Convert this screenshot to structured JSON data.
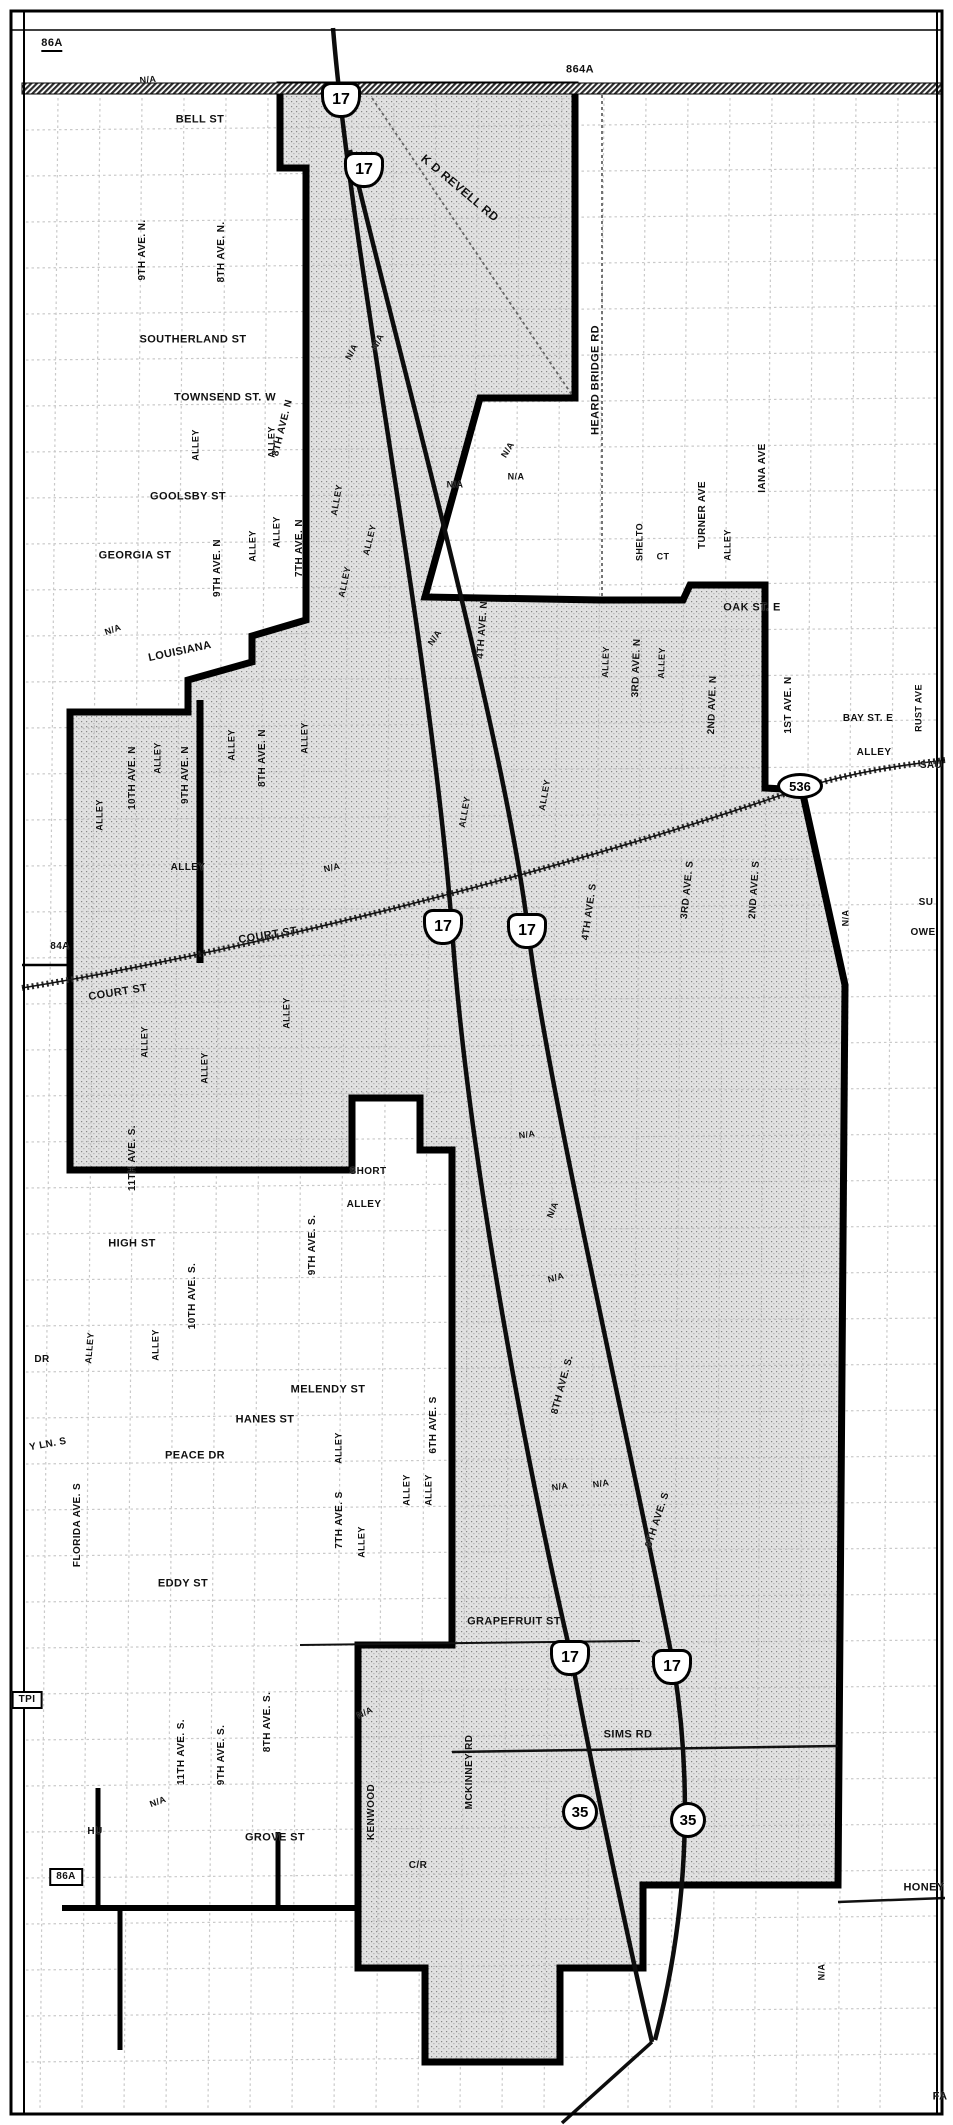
{
  "map": {
    "width": 953,
    "height": 2125,
    "description_labels": {
      "not_applicable": "N/A"
    },
    "colors": {
      "boundary": "#000000",
      "shade_base": "#e1e1e1",
      "shade_dot": "#808080",
      "road": "#111111",
      "grid_line": "#b8b8b8",
      "paper": "#ffffff"
    }
  },
  "route_shields": [
    {
      "kind": "us",
      "num": "17",
      "x": 341,
      "y": 100
    },
    {
      "kind": "us",
      "num": "17",
      "x": 364,
      "y": 170
    },
    {
      "kind": "us",
      "num": "17",
      "x": 443,
      "y": 927
    },
    {
      "kind": "us",
      "num": "17",
      "x": 527,
      "y": 931
    },
    {
      "kind": "us",
      "num": "17",
      "x": 570,
      "y": 1658
    },
    {
      "kind": "us",
      "num": "17",
      "x": 672,
      "y": 1667
    },
    {
      "kind": "circle",
      "num": "35",
      "x": 580,
      "y": 1812
    },
    {
      "kind": "circle",
      "num": "35",
      "x": 688,
      "y": 1820
    },
    {
      "kind": "oval",
      "num": "536",
      "x": 800,
      "y": 786
    }
  ],
  "labels": [
    {
      "t": "86A",
      "x": 52,
      "y": 45,
      "s": 11,
      "u": 1
    },
    {
      "t": "864A",
      "x": 580,
      "y": 70,
      "s": 11
    },
    {
      "t": "N/A",
      "x": 148,
      "y": 80,
      "s": 9,
      "r": -5
    },
    {
      "t": "BELL ST",
      "x": 200,
      "y": 120,
      "s": 11
    },
    {
      "t": "K D REVELL RD",
      "x": 460,
      "y": 188,
      "s": 12,
      "r": 40
    },
    {
      "t": "HEARD BRIDGE RD",
      "x": 596,
      "y": 380,
      "s": 11,
      "r": -90
    },
    {
      "t": "9TH AVE. N.",
      "x": 143,
      "y": 250,
      "s": 10,
      "r": -90
    },
    {
      "t": "8TH AVE. N.",
      "x": 222,
      "y": 252,
      "s": 10,
      "r": -90
    },
    {
      "t": "SOUTHERLAND ST",
      "x": 193,
      "y": 340,
      "s": 11
    },
    {
      "t": "TOWNSEND ST. W",
      "x": 225,
      "y": 398,
      "s": 11
    },
    {
      "t": "ALLEY",
      "x": 196,
      "y": 445,
      "s": 9,
      "r": -90
    },
    {
      "t": "ALLEY",
      "x": 272,
      "y": 442,
      "s": 9,
      "r": -90
    },
    {
      "t": "GOOLSBY ST",
      "x": 188,
      "y": 497,
      "s": 11
    },
    {
      "t": "ALLEY",
      "x": 253,
      "y": 546,
      "s": 9,
      "r": -90
    },
    {
      "t": "ALLEY",
      "x": 277,
      "y": 532,
      "s": 9,
      "r": -90
    },
    {
      "t": "GEORGIA ST",
      "x": 135,
      "y": 556,
      "s": 11
    },
    {
      "t": "9TH AVE. N",
      "x": 218,
      "y": 568,
      "s": 10,
      "r": -90
    },
    {
      "t": "7TH AVE. N",
      "x": 300,
      "y": 548,
      "s": 10,
      "r": -90
    },
    {
      "t": "ALLEY",
      "x": 345,
      "y": 582,
      "s": 9,
      "r": -78
    },
    {
      "t": "N/A",
      "x": 113,
      "y": 630,
      "s": 9,
      "r": -20
    },
    {
      "t": "LOUISIANA",
      "x": 180,
      "y": 652,
      "s": 11,
      "r": -12
    },
    {
      "t": "N/A",
      "x": 352,
      "y": 352,
      "s": 9,
      "r": -62
    },
    {
      "t": "N/A",
      "x": 378,
      "y": 342,
      "s": 9,
      "r": -62
    },
    {
      "t": "8TH AVE. N",
      "x": 283,
      "y": 428,
      "s": 10,
      "r": -76
    },
    {
      "t": "ALLEY",
      "x": 337,
      "y": 500,
      "s": 9,
      "r": -80
    },
    {
      "t": "ALLEY",
      "x": 370,
      "y": 540,
      "s": 9,
      "r": -76
    },
    {
      "t": "N/A",
      "x": 435,
      "y": 638,
      "s": 9,
      "r": -55
    },
    {
      "t": "N/A",
      "x": 455,
      "y": 485,
      "s": 9
    },
    {
      "t": "N/A",
      "x": 508,
      "y": 450,
      "s": 9,
      "r": -58
    },
    {
      "t": "N/A",
      "x": 516,
      "y": 477,
      "s": 9
    },
    {
      "t": "TURNER AVE",
      "x": 703,
      "y": 515,
      "s": 10,
      "r": -90
    },
    {
      "t": "ALLEY",
      "x": 728,
      "y": 545,
      "s": 9,
      "r": -90
    },
    {
      "t": "SHELTO",
      "x": 640,
      "y": 542,
      "s": 9,
      "r": -90
    },
    {
      "t": "CT",
      "x": 663,
      "y": 557,
      "s": 9
    },
    {
      "t": "IANA AVE",
      "x": 763,
      "y": 468,
      "s": 10,
      "r": -90
    },
    {
      "t": "OAK ST. E",
      "x": 752,
      "y": 608,
      "s": 11
    },
    {
      "t": "1ST AVE. N",
      "x": 789,
      "y": 705,
      "s": 10,
      "r": -90
    },
    {
      "t": "ALLEY",
      "x": 874,
      "y": 753,
      "s": 10
    },
    {
      "t": "RUST AVE",
      "x": 919,
      "y": 708,
      "s": 9,
      "r": -90
    },
    {
      "t": "2ND AVE. N",
      "x": 713,
      "y": 705,
      "s": 10,
      "r": -88
    },
    {
      "t": "ALLEY",
      "x": 662,
      "y": 663,
      "s": 9,
      "r": -88
    },
    {
      "t": "3RD AVE. N",
      "x": 637,
      "y": 668,
      "s": 10,
      "r": -88
    },
    {
      "t": "ALLEY",
      "x": 606,
      "y": 662,
      "s": 9,
      "r": -88
    },
    {
      "t": "4TH AVE. N",
      "x": 483,
      "y": 630,
      "s": 10,
      "r": -86
    },
    {
      "t": "ALLEY",
      "x": 545,
      "y": 795,
      "s": 9,
      "r": -80
    },
    {
      "t": "ALLEY",
      "x": 465,
      "y": 812,
      "s": 9,
      "r": -80
    },
    {
      "t": "4TH AVE. S",
      "x": 590,
      "y": 912,
      "s": 10,
      "r": -82
    },
    {
      "t": "3RD AVE. S",
      "x": 688,
      "y": 890,
      "s": 10,
      "r": -84
    },
    {
      "t": "2ND AVE. S",
      "x": 755,
      "y": 890,
      "s": 10,
      "r": -86
    },
    {
      "t": "BAY ST. E",
      "x": 868,
      "y": 719,
      "s": 10
    },
    {
      "t": "SAU",
      "x": 931,
      "y": 766,
      "s": 10
    },
    {
      "t": "N/A",
      "x": 846,
      "y": 918,
      "s": 9,
      "r": -90
    },
    {
      "t": "SU",
      "x": 926,
      "y": 903,
      "s": 10
    },
    {
      "t": "OWE",
      "x": 923,
      "y": 933,
      "s": 10
    },
    {
      "t": "N/A",
      "x": 332,
      "y": 868,
      "s": 9,
      "r": -12
    },
    {
      "t": "ALLEY",
      "x": 188,
      "y": 868,
      "s": 10
    },
    {
      "t": "COURT ST",
      "x": 268,
      "y": 936,
      "s": 11,
      "r": -9
    },
    {
      "t": "84A",
      "x": 60,
      "y": 947,
      "s": 10
    },
    {
      "t": "COURT ST",
      "x": 118,
      "y": 993,
      "s": 11,
      "r": -9
    },
    {
      "t": "ALLEY",
      "x": 100,
      "y": 815,
      "s": 9,
      "r": -90
    },
    {
      "t": "10TH AVE. N",
      "x": 133,
      "y": 778,
      "s": 10,
      "r": -90
    },
    {
      "t": "ALLEY",
      "x": 158,
      "y": 758,
      "s": 9,
      "r": -90
    },
    {
      "t": "9TH AVE. N",
      "x": 186,
      "y": 775,
      "s": 10,
      "r": -90
    },
    {
      "t": "ALLEY",
      "x": 232,
      "y": 745,
      "s": 9,
      "r": -90
    },
    {
      "t": "8TH AVE. N",
      "x": 263,
      "y": 758,
      "s": 10,
      "r": -90
    },
    {
      "t": "ALLEY",
      "x": 305,
      "y": 738,
      "s": 9,
      "r": -90
    },
    {
      "t": "ALLEY",
      "x": 145,
      "y": 1042,
      "s": 9,
      "r": -90
    },
    {
      "t": "ALLEY",
      "x": 205,
      "y": 1068,
      "s": 9,
      "r": -90
    },
    {
      "t": "ALLEY",
      "x": 287,
      "y": 1013,
      "s": 9,
      "r": -90
    },
    {
      "t": "11TH AVE. S.",
      "x": 133,
      "y": 1158,
      "s": 10,
      "r": -90
    },
    {
      "t": "N/A",
      "x": 527,
      "y": 1135,
      "s": 9,
      "r": -8
    },
    {
      "t": "N/A",
      "x": 553,
      "y": 1210,
      "s": 9,
      "r": -68
    },
    {
      "t": "N/A",
      "x": 556,
      "y": 1278,
      "s": 9,
      "r": -15
    },
    {
      "t": "8TH AVE. S.",
      "x": 563,
      "y": 1385,
      "s": 10,
      "r": -75
    },
    {
      "t": "SHORT",
      "x": 368,
      "y": 1172,
      "s": 10
    },
    {
      "t": "ALLEY",
      "x": 364,
      "y": 1205,
      "s": 10
    },
    {
      "t": "HIGH ST",
      "x": 132,
      "y": 1244,
      "s": 11
    },
    {
      "t": "9TH AVE. S.",
      "x": 313,
      "y": 1245,
      "s": 10,
      "r": -90
    },
    {
      "t": "10TH AVE. S.",
      "x": 193,
      "y": 1296,
      "s": 10,
      "r": -90
    },
    {
      "t": "ALLEY",
      "x": 156,
      "y": 1345,
      "s": 9,
      "r": -90
    },
    {
      "t": "ALLEY",
      "x": 90,
      "y": 1348,
      "s": 9,
      "r": -85
    },
    {
      "t": "DR",
      "x": 42,
      "y": 1360,
      "s": 10
    },
    {
      "t": "MELENDY ST",
      "x": 328,
      "y": 1390,
      "s": 11
    },
    {
      "t": "HANES ST",
      "x": 265,
      "y": 1420,
      "s": 11
    },
    {
      "t": "PEACE DR",
      "x": 195,
      "y": 1456,
      "s": 11
    },
    {
      "t": "ALLEY",
      "x": 339,
      "y": 1448,
      "s": 9,
      "r": -90
    },
    {
      "t": "6TH AVE. S",
      "x": 434,
      "y": 1425,
      "s": 10,
      "r": -90
    },
    {
      "t": "Y LN. S",
      "x": 48,
      "y": 1445,
      "s": 10,
      "r": -10
    },
    {
      "t": "FLORIDA AVE. S",
      "x": 78,
      "y": 1525,
      "s": 10,
      "r": -90
    },
    {
      "t": "EDDY ST",
      "x": 183,
      "y": 1584,
      "s": 11
    },
    {
      "t": "7TH AVE. S",
      "x": 340,
      "y": 1520,
      "s": 10,
      "r": -90
    },
    {
      "t": "ALLEY",
      "x": 362,
      "y": 1542,
      "s": 9,
      "r": -90
    },
    {
      "t": "ALLEY",
      "x": 407,
      "y": 1490,
      "s": 9,
      "r": -90
    },
    {
      "t": "ALLEY",
      "x": 429,
      "y": 1490,
      "s": 9,
      "r": -90
    },
    {
      "t": "GRAPEFRUIT ST",
      "x": 514,
      "y": 1622,
      "s": 11
    },
    {
      "t": "N/A",
      "x": 560,
      "y": 1487,
      "s": 9,
      "r": -8
    },
    {
      "t": "N/A",
      "x": 601,
      "y": 1484,
      "s": 9,
      "r": -8
    },
    {
      "t": "8TH AVE. S",
      "x": 658,
      "y": 1520,
      "s": 10,
      "r": -72
    },
    {
      "t": "SIMS RD",
      "x": 628,
      "y": 1735,
      "s": 11
    },
    {
      "t": "N/A",
      "x": 365,
      "y": 1713,
      "s": 9,
      "r": -25
    },
    {
      "t": "KENWOOD",
      "x": 372,
      "y": 1812,
      "s": 10,
      "r": -90
    },
    {
      "t": "C/R",
      "x": 418,
      "y": 1866,
      "s": 10
    },
    {
      "t": "GROVE ST",
      "x": 275,
      "y": 1838,
      "s": 11
    },
    {
      "t": "11TH AVE. S.",
      "x": 182,
      "y": 1752,
      "s": 10,
      "r": -90
    },
    {
      "t": "9TH AVE. S.",
      "x": 222,
      "y": 1755,
      "s": 10,
      "r": -90
    },
    {
      "t": "8TH AVE. S.",
      "x": 268,
      "y": 1722,
      "s": 10,
      "r": -90
    },
    {
      "t": "N/A",
      "x": 158,
      "y": 1802,
      "s": 9,
      "r": -20
    },
    {
      "t": "HU",
      "x": 95,
      "y": 1832,
      "s": 10
    },
    {
      "t": "86A",
      "x": 66,
      "y": 1877,
      "s": 10,
      "b": 1
    },
    {
      "t": "TPI",
      "x": 27,
      "y": 1700,
      "s": 10,
      "b": 1
    },
    {
      "t": "MCKINNEY RD",
      "x": 470,
      "y": 1772,
      "s": 10,
      "r": -90
    },
    {
      "t": "HONEY",
      "x": 924,
      "y": 1888,
      "s": 11
    },
    {
      "t": "N/A",
      "x": 822,
      "y": 1972,
      "s": 9,
      "r": -90
    },
    {
      "t": "FA",
      "x": 940,
      "y": 2097,
      "s": 11
    }
  ]
}
